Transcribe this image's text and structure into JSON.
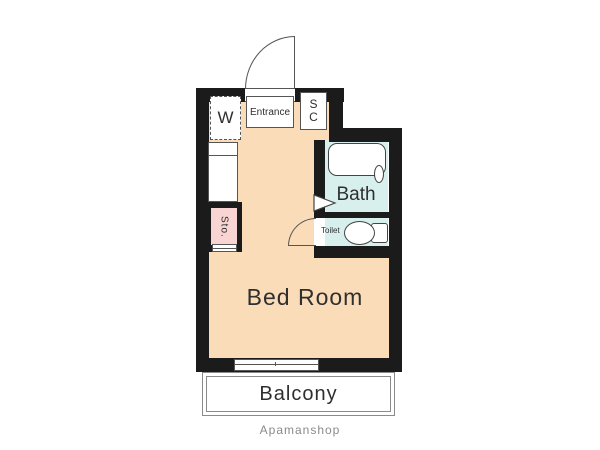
{
  "plan": {
    "type": "apartment-floor-plan",
    "brand": "Apamanshop",
    "rooms": {
      "bedroom": {
        "label": "Bed Room"
      },
      "entrance": {
        "label": "Entrance"
      },
      "bath": {
        "label": "Bath"
      },
      "toilet": {
        "label": "Toilet"
      },
      "balcony": {
        "label": "Balcony"
      },
      "storage": {
        "label": "Sto."
      },
      "washer": {
        "label": "W"
      },
      "shoe_closet": {
        "line1": "S",
        "line2": "C"
      }
    },
    "colors": {
      "floor": "#FADCB9",
      "wet_area": "#D7F0EE",
      "storage": "#F8D4D2",
      "wall": "#1B1B1B",
      "line": "#555555",
      "balcony_line": "#8A8A8A",
      "text": "#2F2F2F",
      "brand_text": "#8A8A8A"
    }
  }
}
